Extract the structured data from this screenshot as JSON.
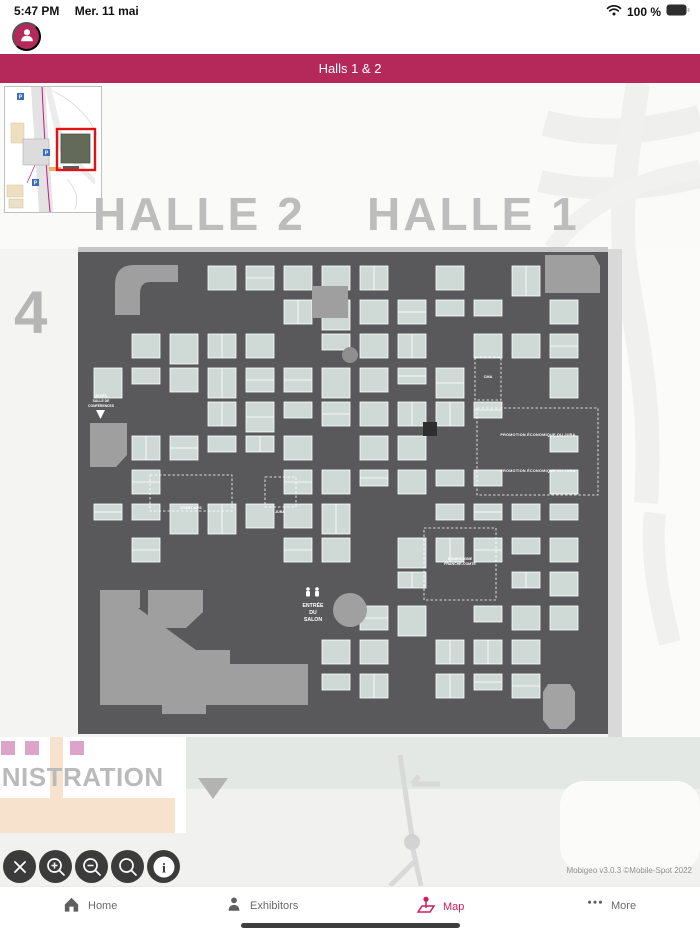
{
  "status_bar": {
    "time": "5:47 PM",
    "date": "Mer. 11 mai",
    "battery": "100 %"
  },
  "header": {
    "title": "Halls 1 & 2"
  },
  "map": {
    "hall_left": "HALLE 2",
    "hall_right": "HALLE 1",
    "zone_number": "4",
    "building_label": "INISTRATION",
    "plan_labels": {
      "entrance_line1": "ENTRÉE",
      "entrance_line2": "DU",
      "entrance_line3": "SALON",
      "conference_line1": "ACCÈS",
      "conference_line2": "SALLE DE",
      "conference_line3": "CONFÉRENCES",
      "startups": "START-UPS",
      "cma": "CMA",
      "promotion_top": "PROMOTION ÉCONOMIQUE DU JURA",
      "promotion_bottom": "PROMOTION ÉCONOMIQUE DU JURA",
      "bourgogne_line1": "BOURGOGNE",
      "bourgogne_line2": "FRANCHE-COMTÉ",
      "jura": "JURA"
    },
    "colors": {
      "accent": "#b5295a",
      "plan_floor": "#59595b",
      "booth": "#cfdad6",
      "structure": "#9f9f9f",
      "hall_text": "#bdbdbd"
    }
  },
  "toolbar": {
    "buttons": [
      {
        "name": "close",
        "icon": "close-icon"
      },
      {
        "name": "zoom-in",
        "icon": "zoom-in-icon"
      },
      {
        "name": "zoom-out",
        "icon": "zoom-out-icon"
      },
      {
        "name": "search",
        "icon": "search-icon"
      },
      {
        "name": "info",
        "icon": "info-icon"
      }
    ]
  },
  "footer": {
    "copyright": "Mobigeo v3.0.3 ©Mobile-Spot 2022"
  },
  "nav": {
    "items": [
      {
        "label": "Home",
        "icon": "home-icon",
        "active": false
      },
      {
        "label": "Exhibitors",
        "icon": "exhibitors-icon",
        "active": false
      },
      {
        "label": "Map",
        "icon": "map-icon",
        "active": true
      },
      {
        "label": "More",
        "icon": "more-icon",
        "active": false
      }
    ],
    "active_color": "#ce1e5b",
    "inactive_color": "#6a6a6a"
  }
}
